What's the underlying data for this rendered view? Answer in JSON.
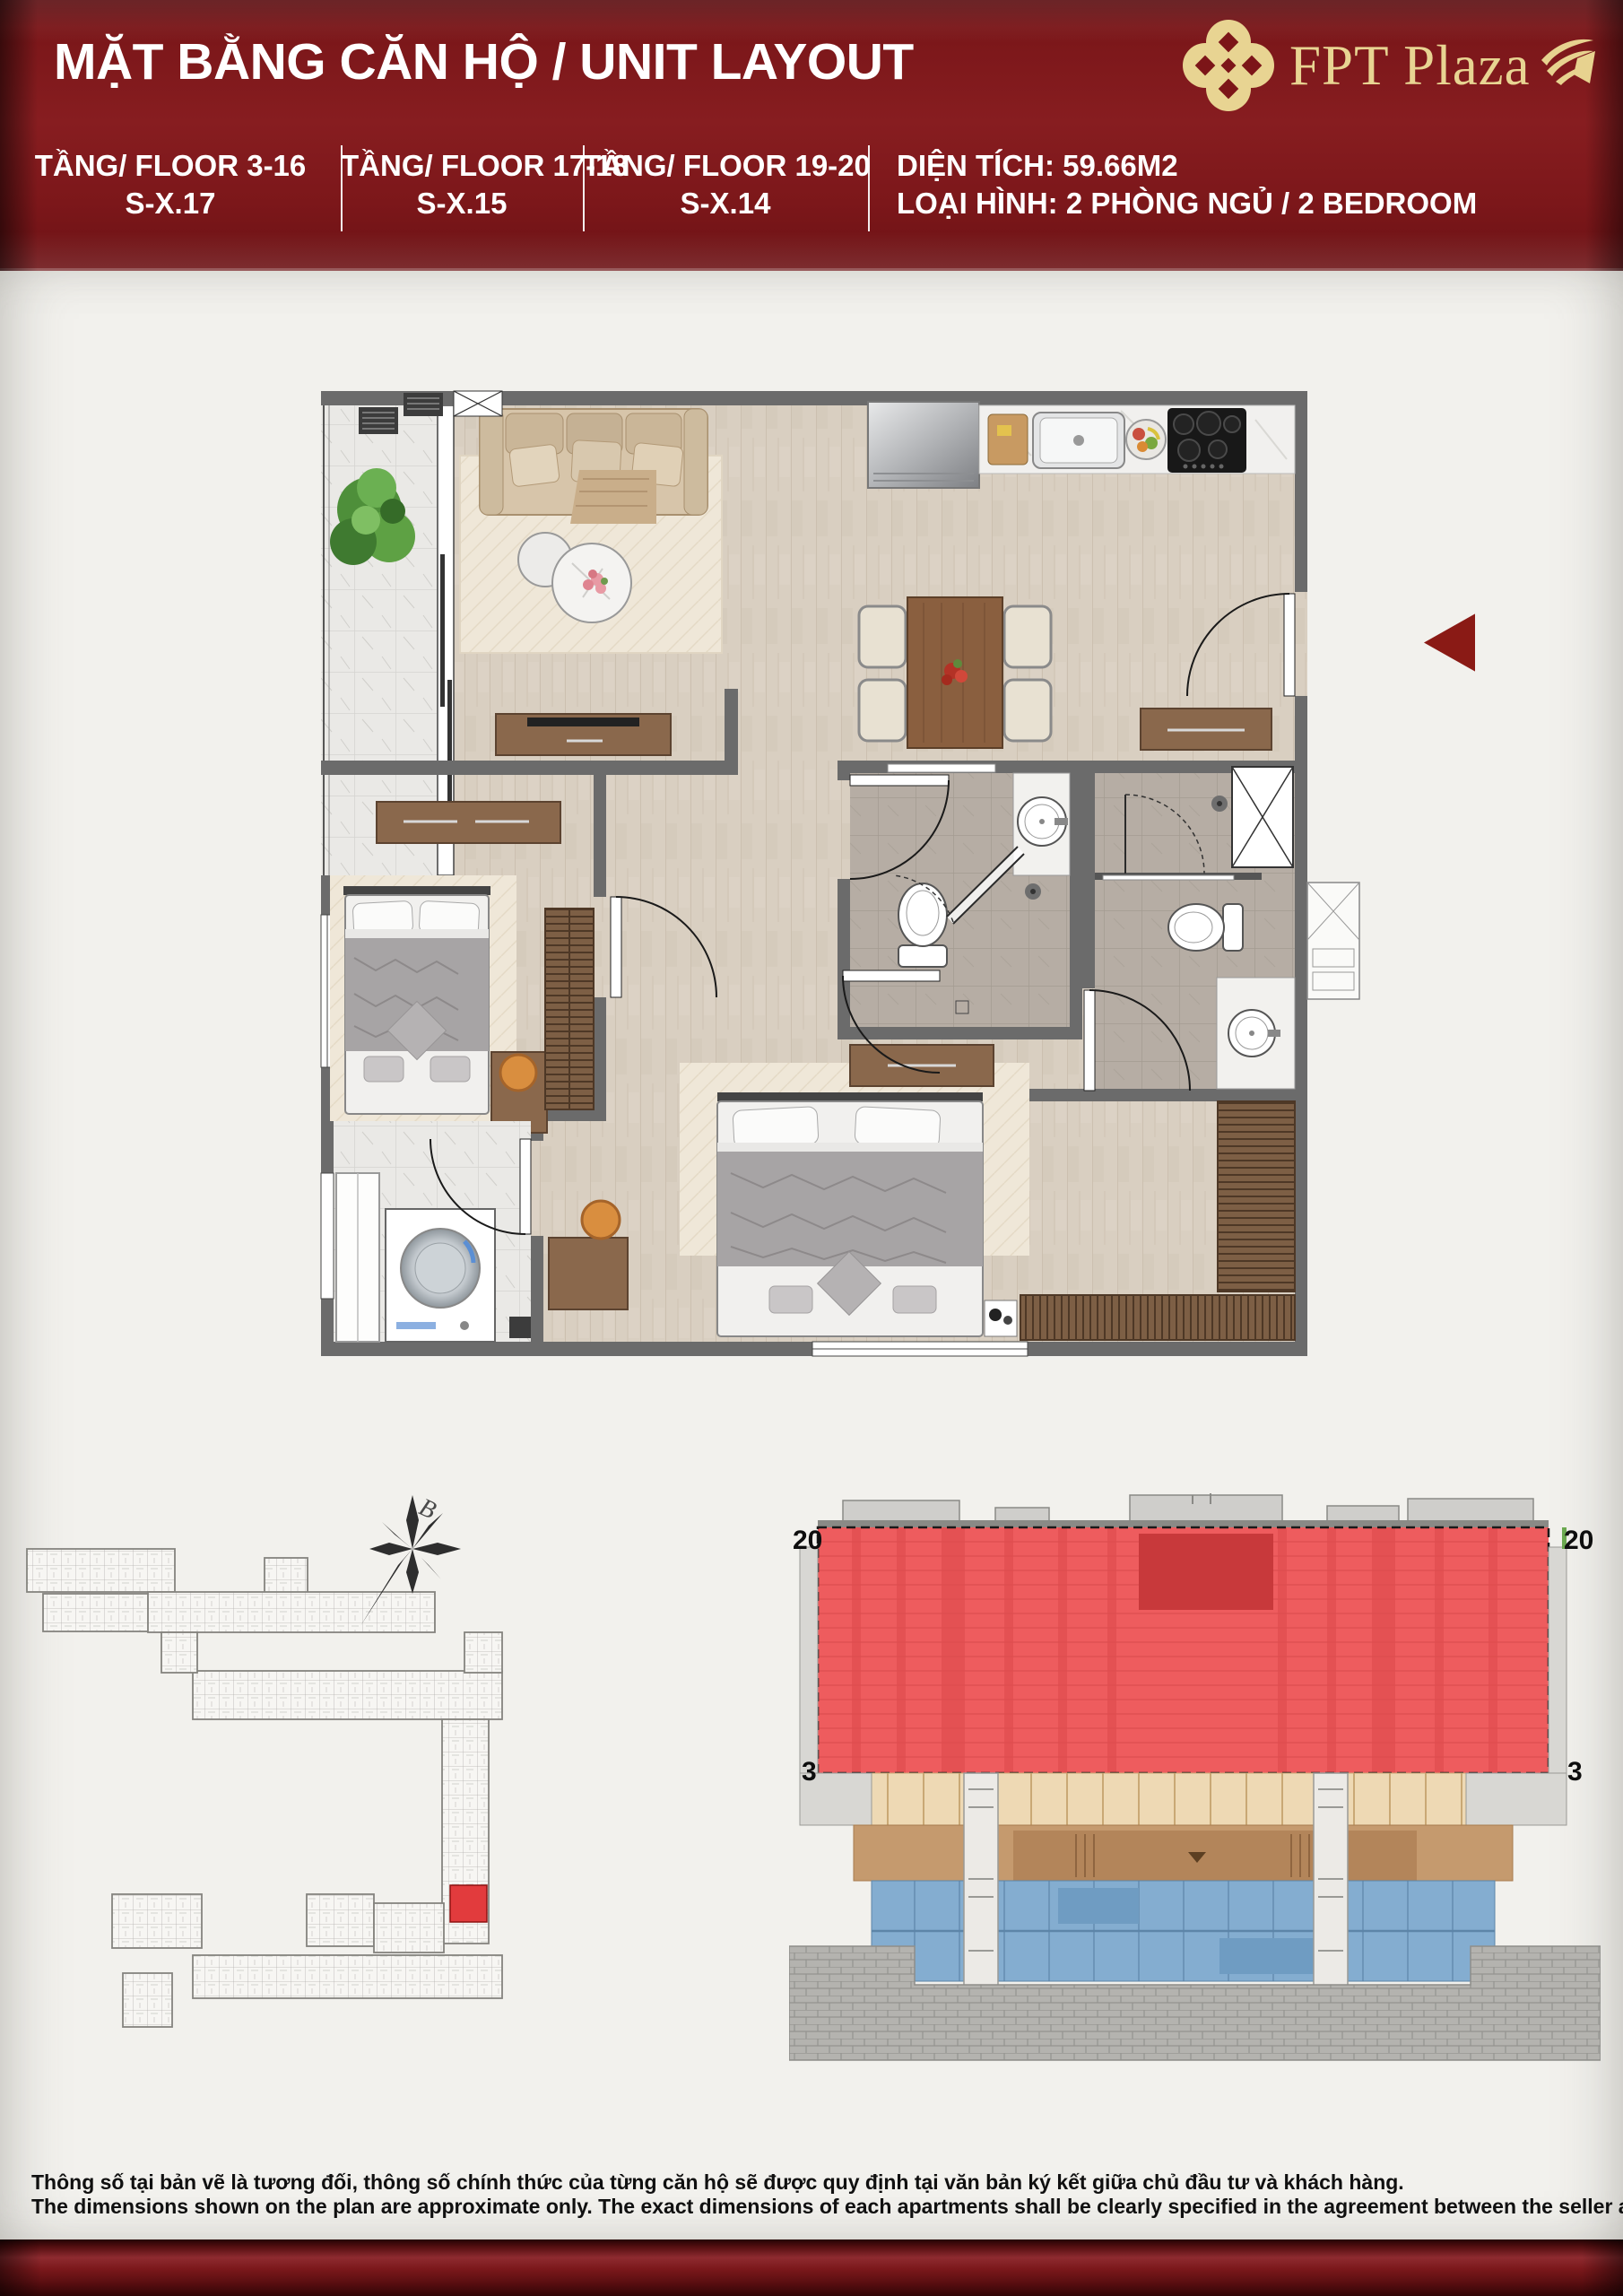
{
  "header": {
    "title": "MẶT BẰNG CĂN HỘ / UNIT LAYOUT",
    "brand_name": "FPT Plaza",
    "panel_color": "#7c1518",
    "brand_gold": "#e8d492",
    "floors": [
      {
        "floor_label": "TẦNG/ FLOOR 3-16",
        "unit_code": "S-X.17"
      },
      {
        "floor_label": "TẦNG/ FLOOR 17-18",
        "unit_code": "S-X.15"
      },
      {
        "floor_label": "TẦNG/ FLOOR 19-20",
        "unit_code": "S-X.14"
      }
    ],
    "area_label": "DIỆN TÍCH: 59.66M2",
    "type_label": "LOẠI HÌNH: 2 PHÒNG NGỦ / 2 BEDROOM"
  },
  "floor_plan": {
    "wall_color": "#6b6b6b",
    "wood_floor_color": "#d9cfc1",
    "marble_color": "#eae9e6",
    "bath_tile_color": "#b6ada4",
    "direction_marker_color": "#8a1a15"
  },
  "site_plan": {
    "north_label": "B",
    "unit_highlight_color": "#e23b3d"
  },
  "cross_section": {
    "top_floor_left": "20",
    "top_floor_right": "20",
    "bottom_floor_left": "3",
    "bottom_floor_right": "3",
    "highlight_color": "#ee5c5e",
    "podium_color": "#eed9b4",
    "basement_color": "#84add0"
  },
  "footer": {
    "disclaimer_vi": "Thông số tại bản vẽ là tương đối, thông số chính thức của từng căn hộ sẽ được quy định tại văn bản ký kết giữa chủ đầu tư và khách hàng.",
    "disclaimer_en": "The dimensions shown on the plan are approximate only. The exact dimensions of each apartments shall be clearly specified in the agreement between the seller and the buyer."
  }
}
